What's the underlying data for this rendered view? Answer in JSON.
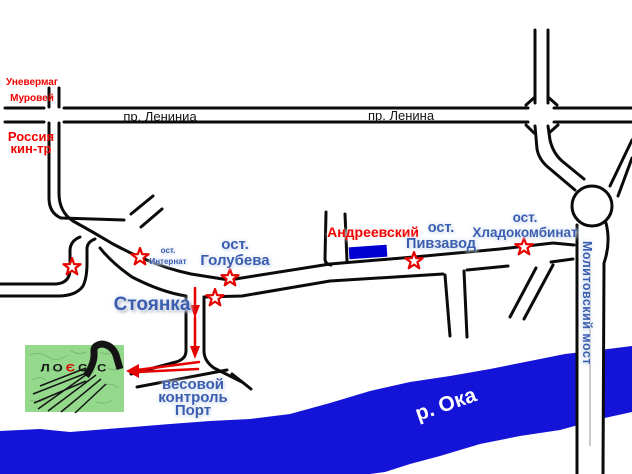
{
  "labels": {
    "univermag": {
      "line1": "Уневермаг",
      "line2": "Муровей"
    },
    "lenin_ave_left": "пр. Лениниа",
    "lenin_ave_right": "пр. Ленина",
    "russia_cinema": {
      "line1": "Россия",
      "line2": "кин-тр"
    },
    "stop_internat": {
      "line1": "ост.",
      "line2": "Интернат"
    },
    "stop_golubeva": {
      "line1": "ост.",
      "line2": "Голубева"
    },
    "andreevsky": "Андреевский",
    "stop_pivzavod": {
      "line1": "ост.",
      "line2": "Пивзавод"
    },
    "stop_hladokombinat": {
      "line1": "ост.",
      "line2": "Хладокомбинат"
    },
    "parking": "Стоянка",
    "weight_control": {
      "line1": "весовой",
      "line2": "контроль",
      "line3": "Порт"
    },
    "bridge": "Молитовский мост",
    "river": "р. Ока",
    "logo": {
      "part1": "ЛО",
      "accent": "Є",
      "part2": "СіС"
    }
  },
  "colors": {
    "river_blue": "#1414d8",
    "label_blue": "#3a5db0",
    "label_red": "#f10000",
    "road_black": "#0b0b0b",
    "route_red": "#e60000",
    "logo_green": "#93d88b",
    "building_blue": "#0000d2",
    "star_outline": "#e60000"
  }
}
